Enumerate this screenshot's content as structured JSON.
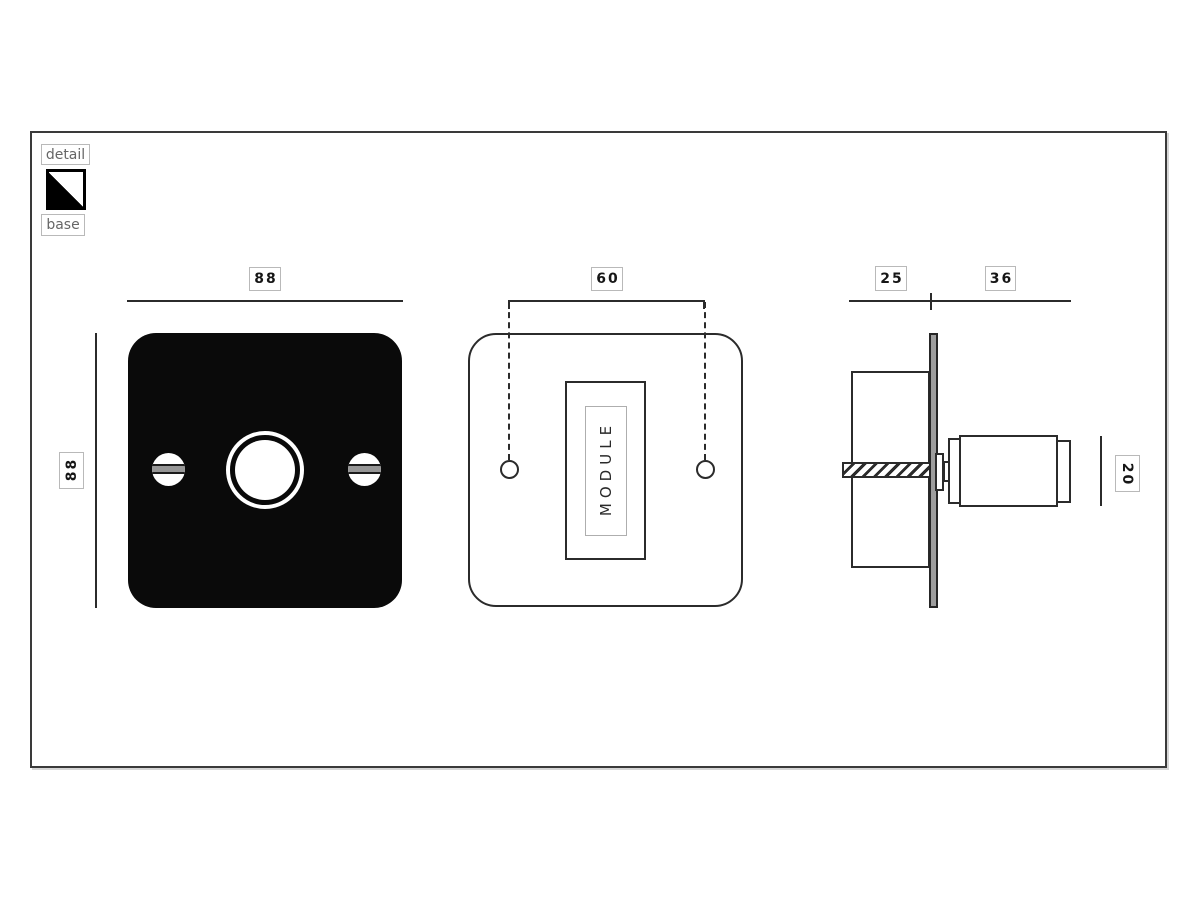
{
  "legend": {
    "detail_label": "detail",
    "base_label": "base",
    "detail_color": "#000000",
    "base_color": "#ffffff"
  },
  "views": {
    "front_detail": {
      "width_dim": "88",
      "height_dim": "88"
    },
    "front_base": {
      "hole_spacing_dim": "60",
      "module_text": "MODULE"
    },
    "side": {
      "recess_depth_dim": "25",
      "projection_dim": "36",
      "knob_diameter_dim": "20"
    }
  },
  "colors": {
    "stroke": "#2b2b2b",
    "detail_plate_fill": "#0a0a0a",
    "metal_gray": "#9e9e9e",
    "label_border": "#b9b9b9"
  }
}
